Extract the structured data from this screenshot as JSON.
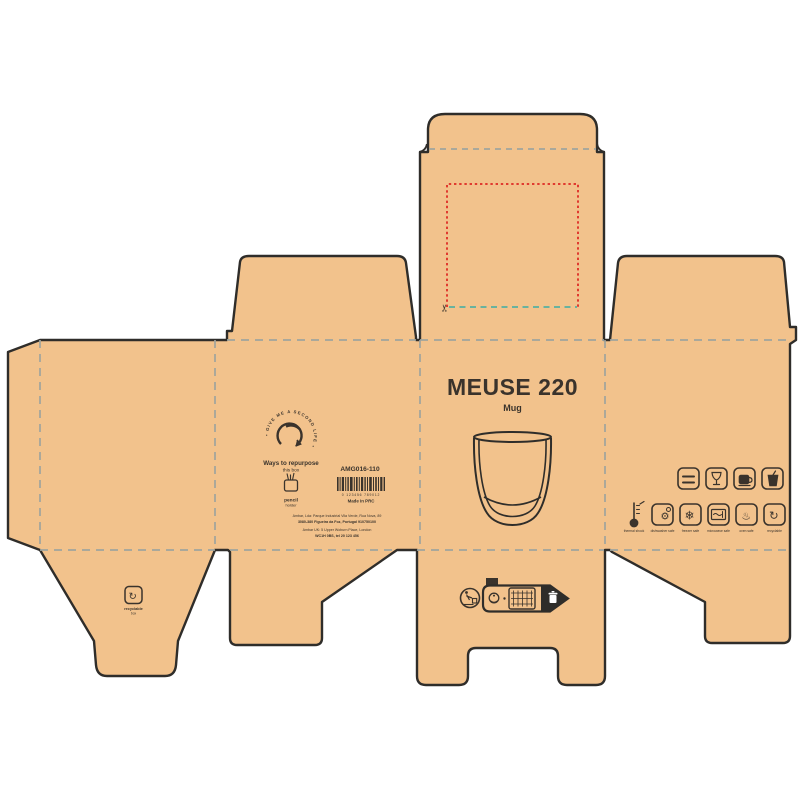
{
  "product": {
    "name": "MEUSE 220",
    "type": "Mug"
  },
  "left_panel": {
    "arc_text": "• GIVE ME A SECOND LIFE •",
    "repurpose_title": "Ways to repurpose",
    "repurpose_sub": "this box",
    "idea_label": "pencil",
    "idea_sublabel": "holder",
    "sku": "AMG016-110",
    "barcode_digits": "0 123456 789012",
    "origin": "Made in PRC",
    "address1": "Ambar, Lda: Parque Industrial Vila Verde, Rua Nova, 89",
    "address2": "3080-380 Figueira da Foz, Portugal 910750100",
    "address3": "Ambar UK: 5 Upper Woburn Place, London",
    "address4": "WC1H 0BS, tel 20 123 456"
  },
  "right_panel": {
    "feature_icons": [
      "double-wall",
      "fragile-glass",
      "hot-drink",
      "cold-drink"
    ],
    "care_icons": [
      "thermometer",
      "dishwasher",
      "freezer",
      "microwave",
      "oven",
      "recyclable"
    ],
    "captions": {
      "thermo": "thermal shock",
      "dishwasher": "dishwasher safe",
      "freezer": "freezer safe",
      "microwave": "microwave safe",
      "oven": "oven safe",
      "recyclable": "recyclable"
    },
    "glyphs": {
      "dishwasher": "⚙",
      "freezer": "❄",
      "oven": "♨",
      "recycle": "↻"
    }
  },
  "bottom": {
    "flap_icon_label": "recyclable",
    "flap_icon_sublabel": "box",
    "infotri_tab": "FR"
  },
  "marks": {
    "scissors": "✂"
  },
  "colors": {
    "board": "#f2c28c",
    "outline": "#2f2d2a",
    "fold_dash": "#a0a49d",
    "teal_dash": "#56b0a0",
    "red_dotted": "#e03a2f",
    "ink": "#3a332c",
    "background": "#ffffff"
  }
}
